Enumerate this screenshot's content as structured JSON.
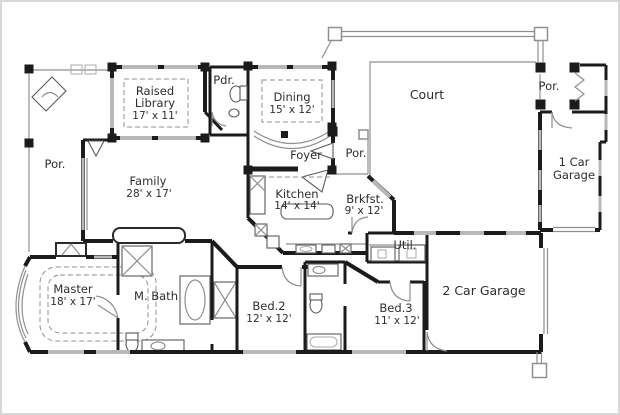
{
  "plan": {
    "type": "house-floor-plan",
    "colors": {
      "background": "#ffffff",
      "wall": "#1b1b1b",
      "window_gray": "#b8b8b8",
      "thin_line": "#8f8f8f",
      "text": "#2e2e2e",
      "frame": "#cfcfcf"
    },
    "rooms": {
      "library": {
        "line1": "Raised",
        "line2": "Library",
        "dims": "17' x 11'"
      },
      "pdr": {
        "name": "Pdr."
      },
      "dining": {
        "name": "Dining",
        "dims": "15' x 12'"
      },
      "court": {
        "name": "Court"
      },
      "por_right": {
        "name": "Por."
      },
      "garage1": {
        "line1": "1 Car",
        "line2": "Garage"
      },
      "foyer": {
        "name": "Foyer"
      },
      "por_center": {
        "name": "Por."
      },
      "por_left": {
        "name": "Por."
      },
      "family": {
        "name": "Family",
        "dims": "28' x 17'"
      },
      "kitchen": {
        "name": "Kitchen",
        "dims": "14' x 14'"
      },
      "brkfst": {
        "name": "Brkfst.",
        "dims": "9' x 12'"
      },
      "util": {
        "name": "Util."
      },
      "master": {
        "name": "Master",
        "dims": "18' x 17'"
      },
      "mbath": {
        "name": "M. Bath"
      },
      "bed2": {
        "name": "Bed.2",
        "dims": "12' x 12'"
      },
      "bed3": {
        "name": "Bed.3",
        "dims": "11' x 12'"
      },
      "garage2": {
        "name": "2 Car Garage"
      }
    }
  }
}
